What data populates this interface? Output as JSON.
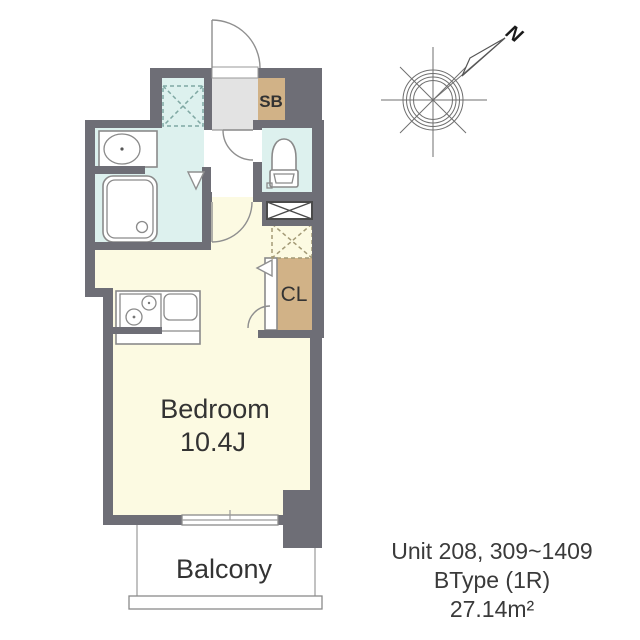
{
  "floor_plan": {
    "rooms": {
      "bedroom": {
        "label": "Bedroom",
        "size": "10.4J"
      },
      "balcony": {
        "label": "Balcony"
      },
      "shoe_box": {
        "label": "SB"
      },
      "closet": {
        "label": "CL"
      }
    },
    "compass": {
      "north_label": "N"
    }
  },
  "unit_info": {
    "units": "Unit 208, 309~1409",
    "type": "BType (1R)",
    "area": "27.14m²"
  },
  "colors": {
    "wall": "#6e6e76",
    "wet_room_floor": "#ddf1ee",
    "room_floor": "#fcfae2",
    "storage": "#d1b287",
    "entrance_floor": "#e3e3e3",
    "outline": "#8a8a8a"
  }
}
